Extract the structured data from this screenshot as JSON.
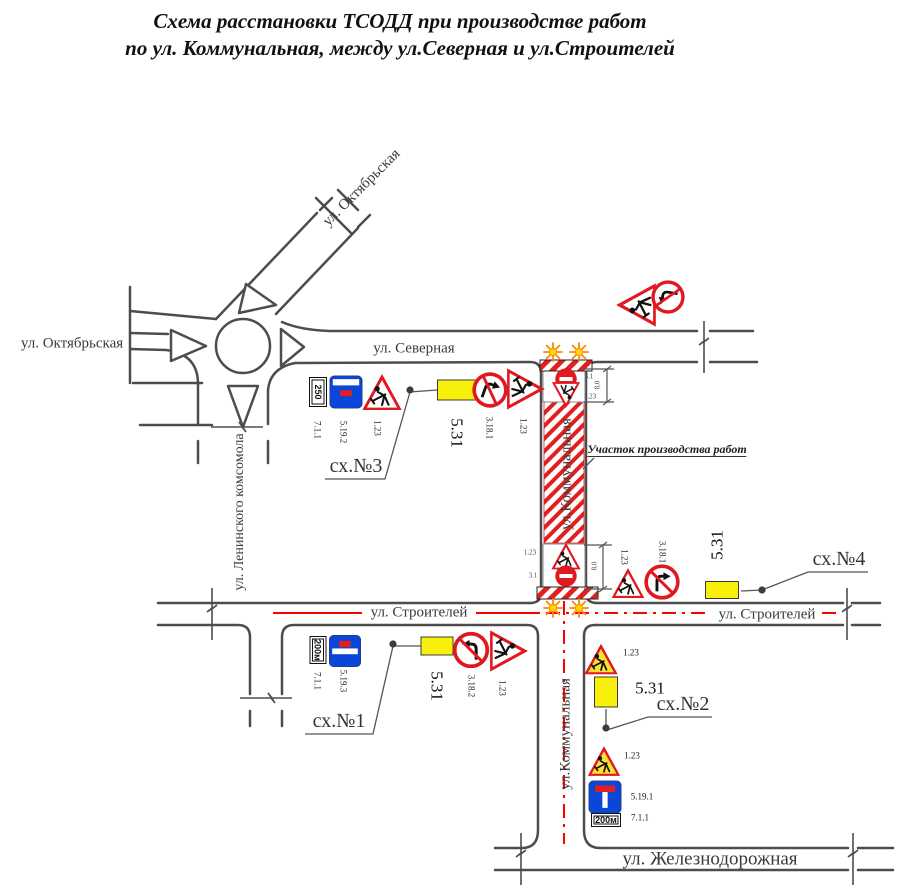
{
  "title": {
    "line1": "Схема расстановки ТСОДД при производстве работ",
    "line2": "по ул. Коммунальная, между ул.Северная и ул.Строителей"
  },
  "streets": {
    "oktyabrskaya_w": "ул. Октябрьская",
    "oktyabrskaya_ne": "ул. Октябрьская",
    "severnaya": "ул. Северная",
    "leninskogo_komsomola": "ул. Ленинского комсомола",
    "kommunalnaya_n": "ул.Коммунальная",
    "kommunalnaya_s": "ул.Коммунальная",
    "stroiteley_w": "ул. Строителей",
    "stroiteley_e": "ул. Строителей",
    "zheleznodorozhnaya": "ул. Железнодорожная"
  },
  "annotations": {
    "work_zone": "Участок производства работ"
  },
  "schemes": {
    "sch1": "сх.№1",
    "sch2": "сх.№2",
    "sch3": "сх.№3",
    "sch4": "сх.№4"
  },
  "colors": {
    "road": "#4d4d4d",
    "marking_red": "#ff0000",
    "sign_red": "#e01820",
    "sign_blue": "#0a46d8",
    "detour_yellow": "#f8ef0b",
    "temp_sign_yellow": "#ffe133",
    "light_core": "#ffd800",
    "light_rays": "#ff8800"
  },
  "signs": [
    {
      "name": "plate-7-1-1-250",
      "type": "plate",
      "text": "250",
      "cx": 318,
      "cy": 392,
      "w": 30,
      "h": 18,
      "rot": 90,
      "label": {
        "text": "7.1.1",
        "cx": 317,
        "cy": 430,
        "rot": 90
      }
    },
    {
      "name": "sign-5-19-2-dead-end",
      "type": "deadend",
      "variant": 2,
      "cx": 346,
      "cy": 392,
      "w": 33,
      "h": 33,
      "rot": 0,
      "label": {
        "text": "5.19.2",
        "cx": 343,
        "cy": 432,
        "rot": 90
      }
    },
    {
      "name": "sign-1-23-roadworks",
      "type": "triangle",
      "bg": "#ffffff",
      "cx": 382,
      "cy": 392,
      "w": 41,
      "h": 38,
      "rot": 0,
      "label": {
        "text": "1.23",
        "cx": 377,
        "cy": 428,
        "rot": 90
      }
    },
    {
      "name": "sign-5-31-detour",
      "type": "detour",
      "cx": 458,
      "cy": 390,
      "w": 42,
      "h": 21,
      "rot": 0,
      "label": {
        "text": "5.31",
        "cx": 457,
        "cy": 433,
        "rot": 90,
        "big": true
      }
    },
    {
      "name": "sign-3-18-1-no-right-turn",
      "type": "noturn",
      "dir": "right",
      "cx": 490,
      "cy": 390,
      "w": 36,
      "h": 36,
      "rot": 20,
      "label": {
        "text": "3.18.1",
        "cx": 489,
        "cy": 428,
        "rot": 90
      }
    },
    {
      "name": "sign-1-23-roadworks",
      "type": "triangle",
      "bg": "#ffffff",
      "cx": 526,
      "cy": 389,
      "w": 43,
      "h": 40,
      "rot": 90,
      "label": {
        "text": "1.23",
        "cx": 523,
        "cy": 426,
        "rot": 90
      }
    },
    {
      "name": "sign-3-1-no-entry",
      "type": "noentry",
      "cx": 566,
      "cy": 379,
      "w": 22,
      "h": 22,
      "rot": 0
    },
    {
      "name": "sign-1-23-roadworks",
      "type": "triangle",
      "bg": "#ffffff",
      "cx": 566,
      "cy": 395,
      "w": 30,
      "h": 27,
      "rot": 180
    },
    {
      "name": "sign-1-23-roadworks",
      "type": "triangle",
      "bg": "#ffffff",
      "cx": 636,
      "cy": 305,
      "w": 45,
      "h": 43,
      "rot": -90
    },
    {
      "name": "sign-3-18-2-no-left-turn",
      "type": "noturn",
      "dir": "left",
      "cx": 668,
      "cy": 297,
      "w": 34,
      "h": 34,
      "rot": -80
    },
    {
      "name": "sign-1-23-roadworks",
      "type": "triangle",
      "bg": "#ffffff",
      "cx": 566,
      "cy": 556,
      "w": 32,
      "h": 28,
      "rot": 0
    },
    {
      "name": "sign-3-1-no-entry",
      "type": "noentry",
      "cx": 566,
      "cy": 576,
      "w": 22,
      "h": 22,
      "rot": 0
    },
    {
      "name": "sign-1-23-roadworks",
      "type": "triangle",
      "bg": "#ffffff",
      "cx": 628,
      "cy": 583,
      "w": 34,
      "h": 32,
      "rot": 0,
      "label": {
        "text": "1.23",
        "cx": 624,
        "cy": 557,
        "rot": 90
      }
    },
    {
      "name": "sign-3-18-1-no-right-turn",
      "type": "noturn",
      "dir": "right",
      "cx": 662,
      "cy": 582,
      "w": 36,
      "h": 36,
      "rot": 0,
      "label": {
        "text": "3.18.1",
        "cx": 662,
        "cy": 552,
        "rot": 90
      }
    },
    {
      "name": "sign-5-31-detour",
      "type": "detour",
      "cx": 722,
      "cy": 590,
      "w": 34,
      "h": 18,
      "rot": 0,
      "label": {
        "text": "5.31",
        "cx": 717,
        "cy": 545,
        "rot": -90,
        "big": true
      }
    },
    {
      "name": "plate-7-1-1-200m",
      "type": "plate",
      "text": "200м",
      "cx": 318,
      "cy": 650,
      "w": 28,
      "h": 17,
      "rot": 90,
      "label": {
        "text": "7.1.1",
        "cx": 317,
        "cy": 681,
        "rot": 90
      }
    },
    {
      "name": "sign-5-19-3-dead-end",
      "type": "deadend",
      "variant": 3,
      "cx": 345,
      "cy": 651,
      "w": 32,
      "h": 32,
      "rot": 0,
      "label": {
        "text": "5.19.3",
        "cx": 343,
        "cy": 681,
        "rot": 90
      }
    },
    {
      "name": "sign-5-31-detour",
      "type": "detour",
      "cx": 437,
      "cy": 646,
      "w": 33,
      "h": 19,
      "rot": 0,
      "label": {
        "text": "5.31",
        "cx": 437,
        "cy": 686,
        "rot": 90,
        "big": true
      }
    },
    {
      "name": "sign-3-18-2-no-left-turn",
      "type": "noturn",
      "dir": "left",
      "cx": 471,
      "cy": 650,
      "w": 37,
      "h": 37,
      "rot": 0,
      "label": {
        "text": "3.18.2",
        "cx": 471,
        "cy": 686,
        "rot": 90
      }
    },
    {
      "name": "sign-1-23-roadworks",
      "type": "triangle",
      "bg": "#ffffff",
      "cx": 509,
      "cy": 651,
      "w": 43,
      "h": 41,
      "rot": 90,
      "label": {
        "text": "1.23",
        "cx": 502,
        "cy": 688,
        "rot": 90
      }
    },
    {
      "name": "sign-1-23-roadworks",
      "type": "triangle",
      "bg": "#ffe133",
      "cx": 601,
      "cy": 659,
      "w": 36,
      "h": 32,
      "rot": 0,
      "label": {
        "text": "1.23",
        "cx": 631,
        "cy": 653,
        "rot": 0
      }
    },
    {
      "name": "sign-5-31-detour",
      "type": "detour",
      "cx": 606,
      "cy": 692,
      "w": 24,
      "h": 31,
      "rot": 0,
      "label": {
        "text": "5.31",
        "cx": 650,
        "cy": 688,
        "rot": 0,
        "big": true
      }
    },
    {
      "name": "sign-1-23-roadworks",
      "type": "triangle",
      "bg": "#ffe133",
      "cx": 604,
      "cy": 761,
      "w": 35,
      "h": 31,
      "rot": 0,
      "label": {
        "text": "1.23",
        "cx": 632,
        "cy": 756,
        "rot": 0
      }
    },
    {
      "name": "sign-5-19-1-dead-end",
      "type": "deadend",
      "variant": 1,
      "cx": 605,
      "cy": 797,
      "w": 34,
      "h": 33,
      "rot": 0,
      "label": {
        "text": "5.19.1",
        "cx": 642,
        "cy": 797,
        "rot": 0
      }
    },
    {
      "name": "plate-7-1-1-200m",
      "type": "plate",
      "text": "200м",
      "cx": 606,
      "cy": 820,
      "w": 30,
      "h": 14,
      "rot": 0,
      "label": {
        "text": "7.1.1",
        "cx": 640,
        "cy": 818,
        "rot": 0
      }
    }
  ],
  "micro_labels": [
    {
      "text": "3.1",
      "cx": 589,
      "cy": 377,
      "rot": 0
    },
    {
      "text": "1.23",
      "cx": 590,
      "cy": 397,
      "rot": 0
    },
    {
      "text": "8,0",
      "cx": 598,
      "cy": 385,
      "rot": -90
    },
    {
      "text": "1.23",
      "cx": 530,
      "cy": 553,
      "rot": 0
    },
    {
      "text": "3.1",
      "cx": 533,
      "cy": 576,
      "rot": 0
    },
    {
      "text": "8,0",
      "cx": 595,
      "cy": 566,
      "rot": -90
    }
  ]
}
